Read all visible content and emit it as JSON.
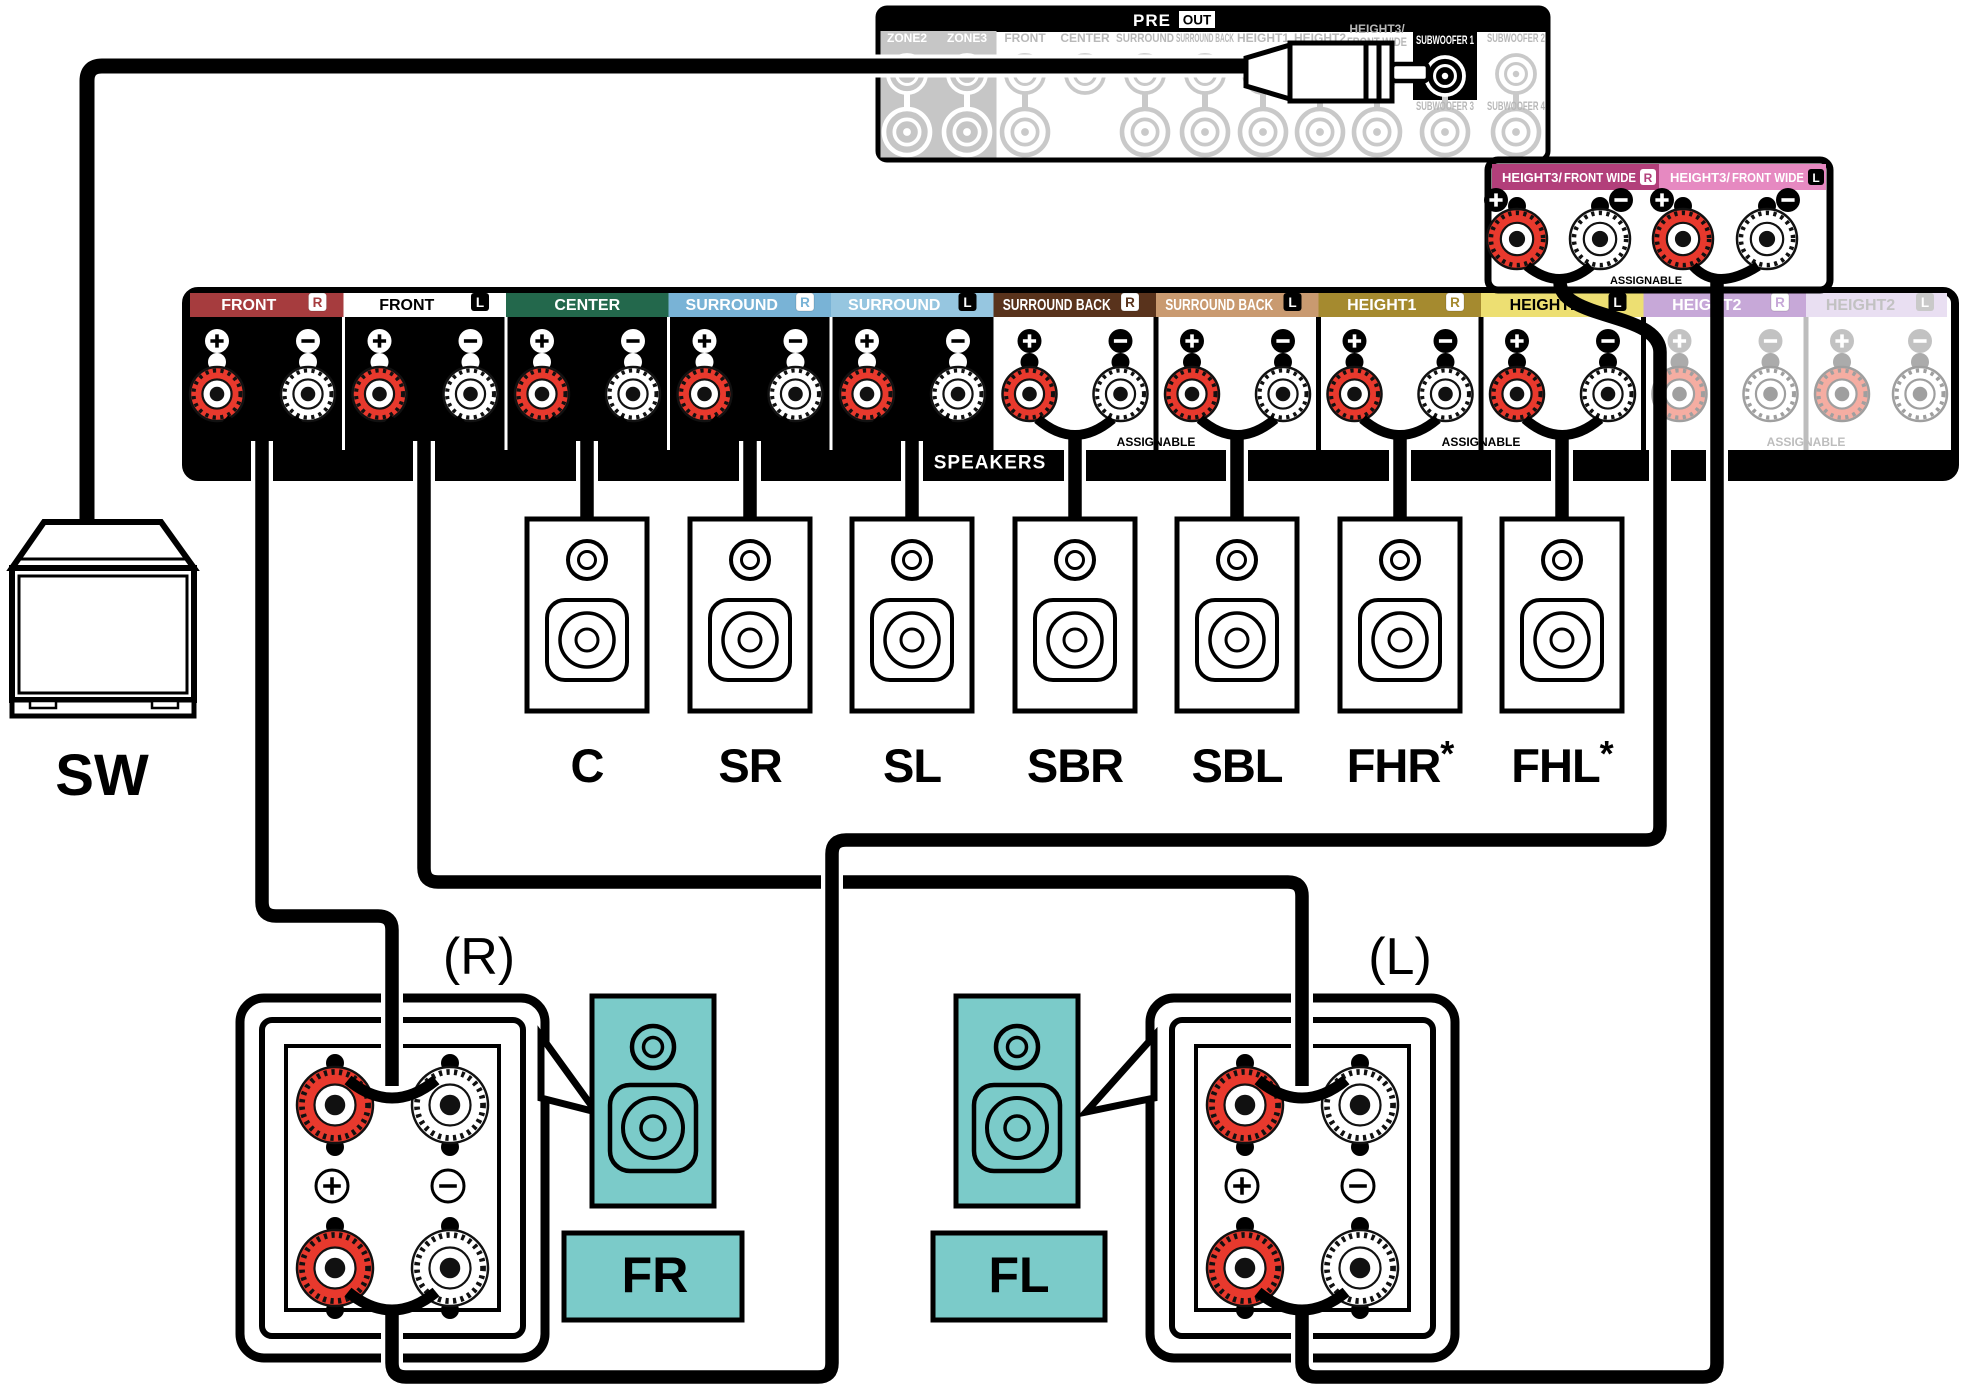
{
  "pre_out": {
    "pre": "PRE",
    "out": "OUT",
    "columns": [
      {
        "label": "ZONE2"
      },
      {
        "label": "ZONE3"
      },
      {
        "label": "FRONT"
      },
      {
        "label": "CENTER"
      },
      {
        "label": "SURROUND"
      },
      {
        "label": "SURROUND BACK"
      },
      {
        "label": "HEIGHT1"
      },
      {
        "label": "HEIGHT2"
      },
      {
        "line1": "HEIGHT3/",
        "line2": "FRONT WIDE"
      },
      {
        "label": "SUBWOOFER 1",
        "sub": "SUBWOOFER 3"
      },
      {
        "label": "SUBWOOFER 2",
        "sub": "SUBWOOFER 4"
      }
    ]
  },
  "height3_panel": {
    "title": "HEIGHT3/",
    "subtitle": "FRONT WIDE",
    "badge_r": "R",
    "badge_l": "L",
    "assignable": "ASSIGNABLE",
    "color_r": "#B23F7A",
    "color_l": "#E689C1"
  },
  "strip": {
    "speakers_label": "SPEAKERS",
    "assignable": "ASSIGNABLE",
    "sections": [
      {
        "label": "FRONT",
        "badge": "R",
        "color": "#A63C3E",
        "text_color": "#FFFFFF"
      },
      {
        "label": "FRONT",
        "badge": "L",
        "color": "#FFFFFF",
        "text_color": "#000000"
      },
      {
        "label": "CENTER",
        "color": "#23684C",
        "text_color": "#FFFFFF"
      },
      {
        "label": "SURROUND",
        "badge": "R",
        "color": "#79B3D6",
        "text_color": "#FFFFFF"
      },
      {
        "label": "SURROUND",
        "badge": "L",
        "color": "#96C6E0",
        "text_color": "#FFFFFF"
      },
      {
        "label": "SURROUND BACK",
        "badge": "R",
        "color": "#59331C",
        "text_color": "#FFFFFF"
      },
      {
        "label": "SURROUND BACK",
        "badge": "L",
        "color": "#C99A70",
        "text_color": "#FFFFFF"
      },
      {
        "label": "HEIGHT1",
        "badge": "R",
        "color": "#A58A2F",
        "text_color": "#FFFFFF"
      },
      {
        "label": "HEIGHT1",
        "badge": "L",
        "color": "#EDDF72",
        "text_color": "#000000"
      },
      {
        "label": "HEIGHT2",
        "badge": "R",
        "color": "#C7A8D8",
        "text_color": "#FFFFFF",
        "grayed": true
      },
      {
        "label": "HEIGHT2",
        "badge": "L",
        "color": "#E9DFF2",
        "text_color": "#C2C2C2",
        "grayed": true
      }
    ]
  },
  "speakers": [
    {
      "label": "C"
    },
    {
      "label": "SR"
    },
    {
      "label": "SL"
    },
    {
      "label": "SBR"
    },
    {
      "label": "SBL"
    },
    {
      "label": "FHR",
      "suffix": "*"
    },
    {
      "label": "FHL",
      "suffix": "*"
    }
  ],
  "subwoofer": {
    "label": "SW"
  },
  "front_pair": {
    "right_tag": "(R)",
    "left_tag": "(L)",
    "fr": "FR",
    "fl": "FL"
  },
  "colors": {
    "post_red": "#E8392D",
    "teal": "#7BCBC9",
    "inactive_gray": "#B8B8B8",
    "line_gray": "#C9C9C9",
    "zone_block": "#C6C6C6",
    "grayed_red": "#F5ADA2",
    "grayed_stroke": "#9F9F9F"
  }
}
